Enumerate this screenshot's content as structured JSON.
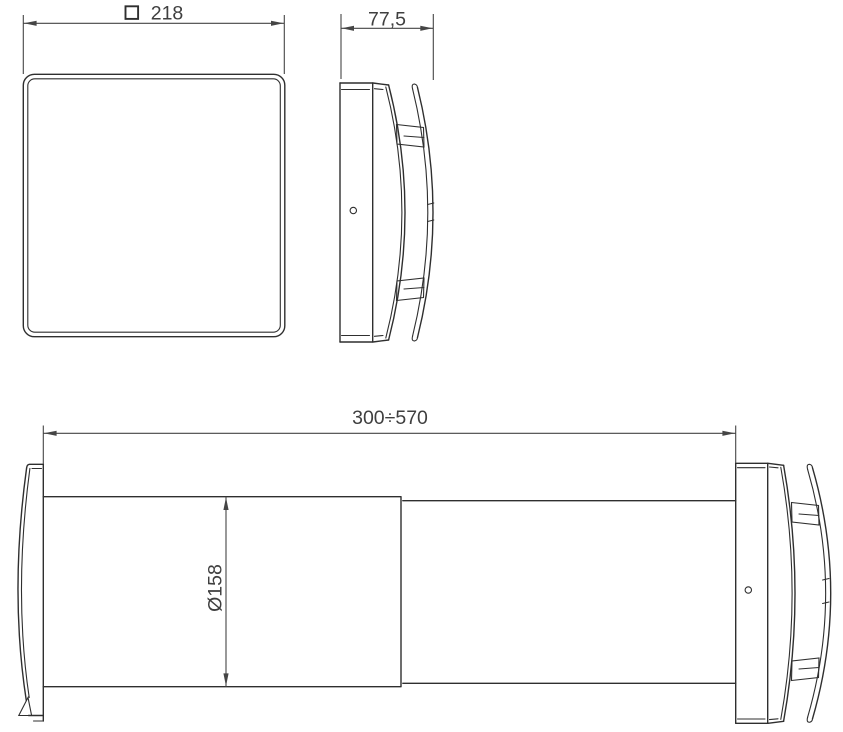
{
  "meta": {
    "background": "#ffffff",
    "line_color": "#2f2f2f",
    "text_color": "#3f3f3f"
  },
  "views": {
    "front": {
      "dimension_width": {
        "symbol": "square-section",
        "value": "218"
      }
    },
    "side": {
      "dimension_depth": {
        "value": "77,5"
      }
    },
    "section": {
      "dimension_length": {
        "value": "300÷570"
      },
      "dimension_diameter": {
        "value": "Ø158"
      }
    }
  }
}
